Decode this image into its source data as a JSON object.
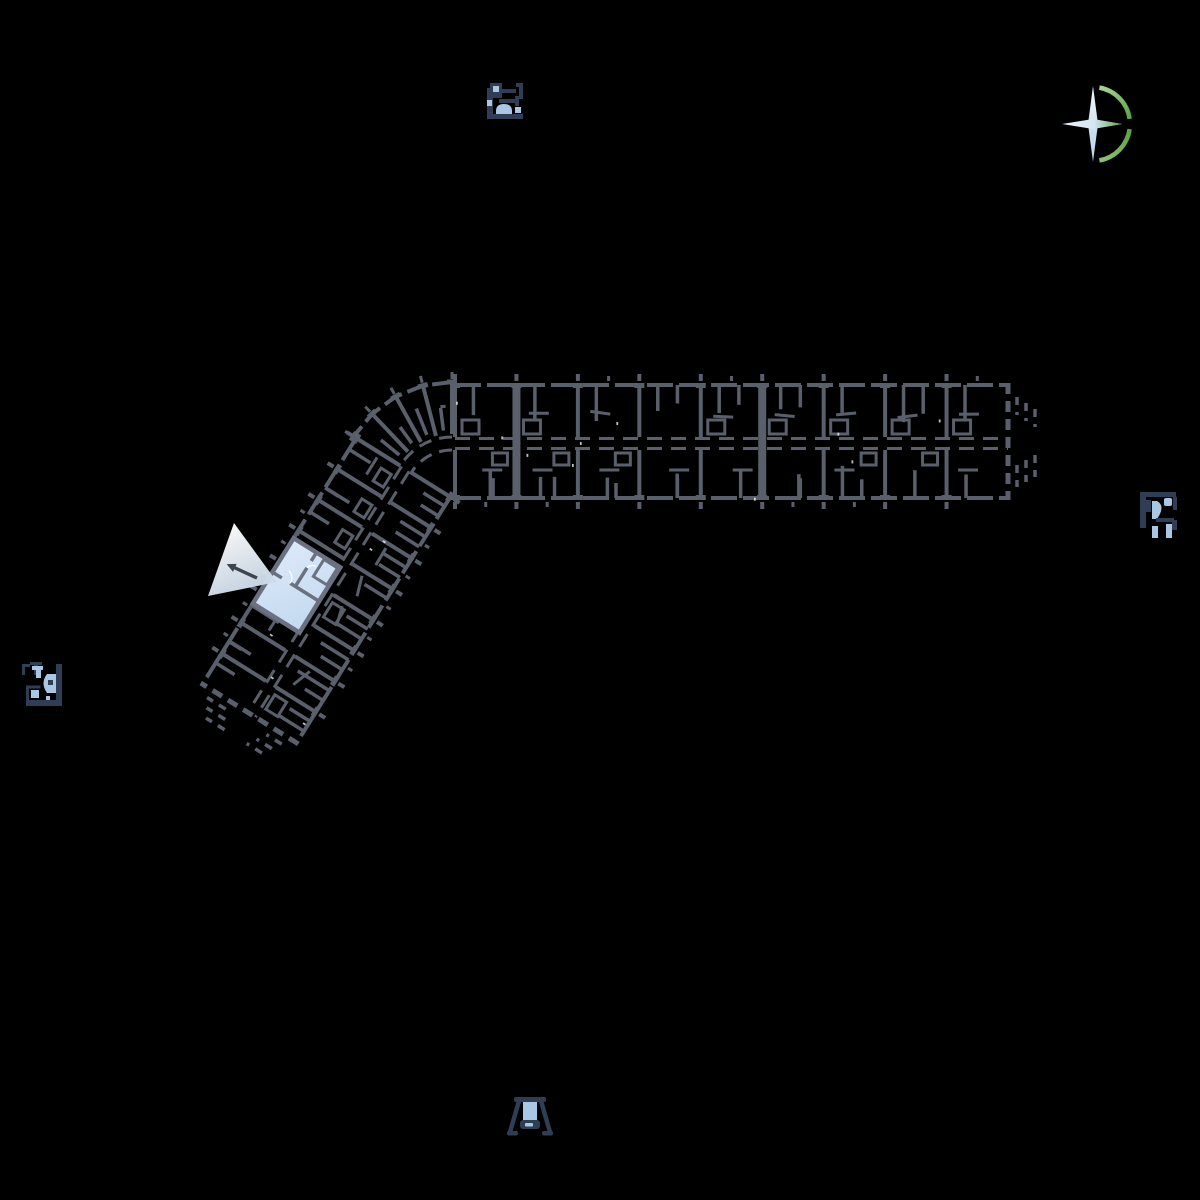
{
  "app": {
    "name": "residential-site-plan-viewer",
    "description": "Black-canvas site plan with one highlighted apartment unit, a view-direction cone, surrounding mini plan markers, a playground marker and a compass rose"
  },
  "colors": {
    "background": "#000000",
    "wall": "#5a5f6c",
    "wall_cap": "#666b78",
    "speckle": "#ffffff",
    "unit_fill_light": "#dceafa",
    "unit_fill_dark": "#c3d8ef",
    "unit_wall": "#6b7180",
    "cone_start": "#ffffff",
    "cone_end": "#c2d3e6",
    "arrow": "#3d434f",
    "icon_navy": "#2f3d55",
    "icon_blue": "#a9c6e4",
    "compass_star_light": "#ffffff",
    "compass_star_blue": "#c6dcee",
    "compass_green": "#57a53e",
    "compass_green_light": "#a6cf8d"
  },
  "floorplan": {
    "seed": 11,
    "east_wing": {
      "x": 455,
      "y": 383,
      "length": 553,
      "width": 117,
      "corridor_y": 54,
      "corridor_h": 13,
      "bays": 9,
      "joints": [
        1,
        5
      ],
      "end_dashed": true
    },
    "southwest_wing": {
      "x": 452,
      "y": 498,
      "rotate": 122,
      "length": 290,
      "width": 115,
      "corridor_y": 49,
      "corridor_h": 12,
      "bays": 8,
      "joints": [],
      "end_dashed": true
    },
    "bend": {
      "pivot": [
        452,
        498
      ],
      "angles": [
        -90,
        -104.5,
        -119,
        -133.5,
        -148
      ],
      "spoke_inner_r": 64,
      "outer_r": 116,
      "corridor_r1": 48,
      "corridor_r2": 61
    },
    "selected_unit": {
      "wing": "southwest",
      "x1": 118,
      "x2": 195,
      "y1": 58,
      "y2": 113
    },
    "view_cone": {
      "points": [
        [
          277,
          582
        ],
        [
          234,
          523
        ],
        [
          208,
          596
        ]
      ],
      "arrow_from": [
        257,
        578
      ],
      "arrow_to": [
        233,
        567
      ]
    }
  },
  "markers": {
    "top_plan": {
      "x": 487,
      "y": 83,
      "meaning": "adjacent building floor-plan marker"
    },
    "right_plan": {
      "x": 1140,
      "y": 492,
      "meaning": "adjacent building floor-plan marker"
    },
    "left_plan": {
      "x": 20,
      "y": 660,
      "meaning": "adjacent building floor-plan marker"
    },
    "swing": {
      "x": 507,
      "y": 1095,
      "meaning": "playground swing marker"
    },
    "compass": {
      "cx": 1093,
      "cy": 124,
      "meaning": "compass rose / north indicator"
    }
  }
}
